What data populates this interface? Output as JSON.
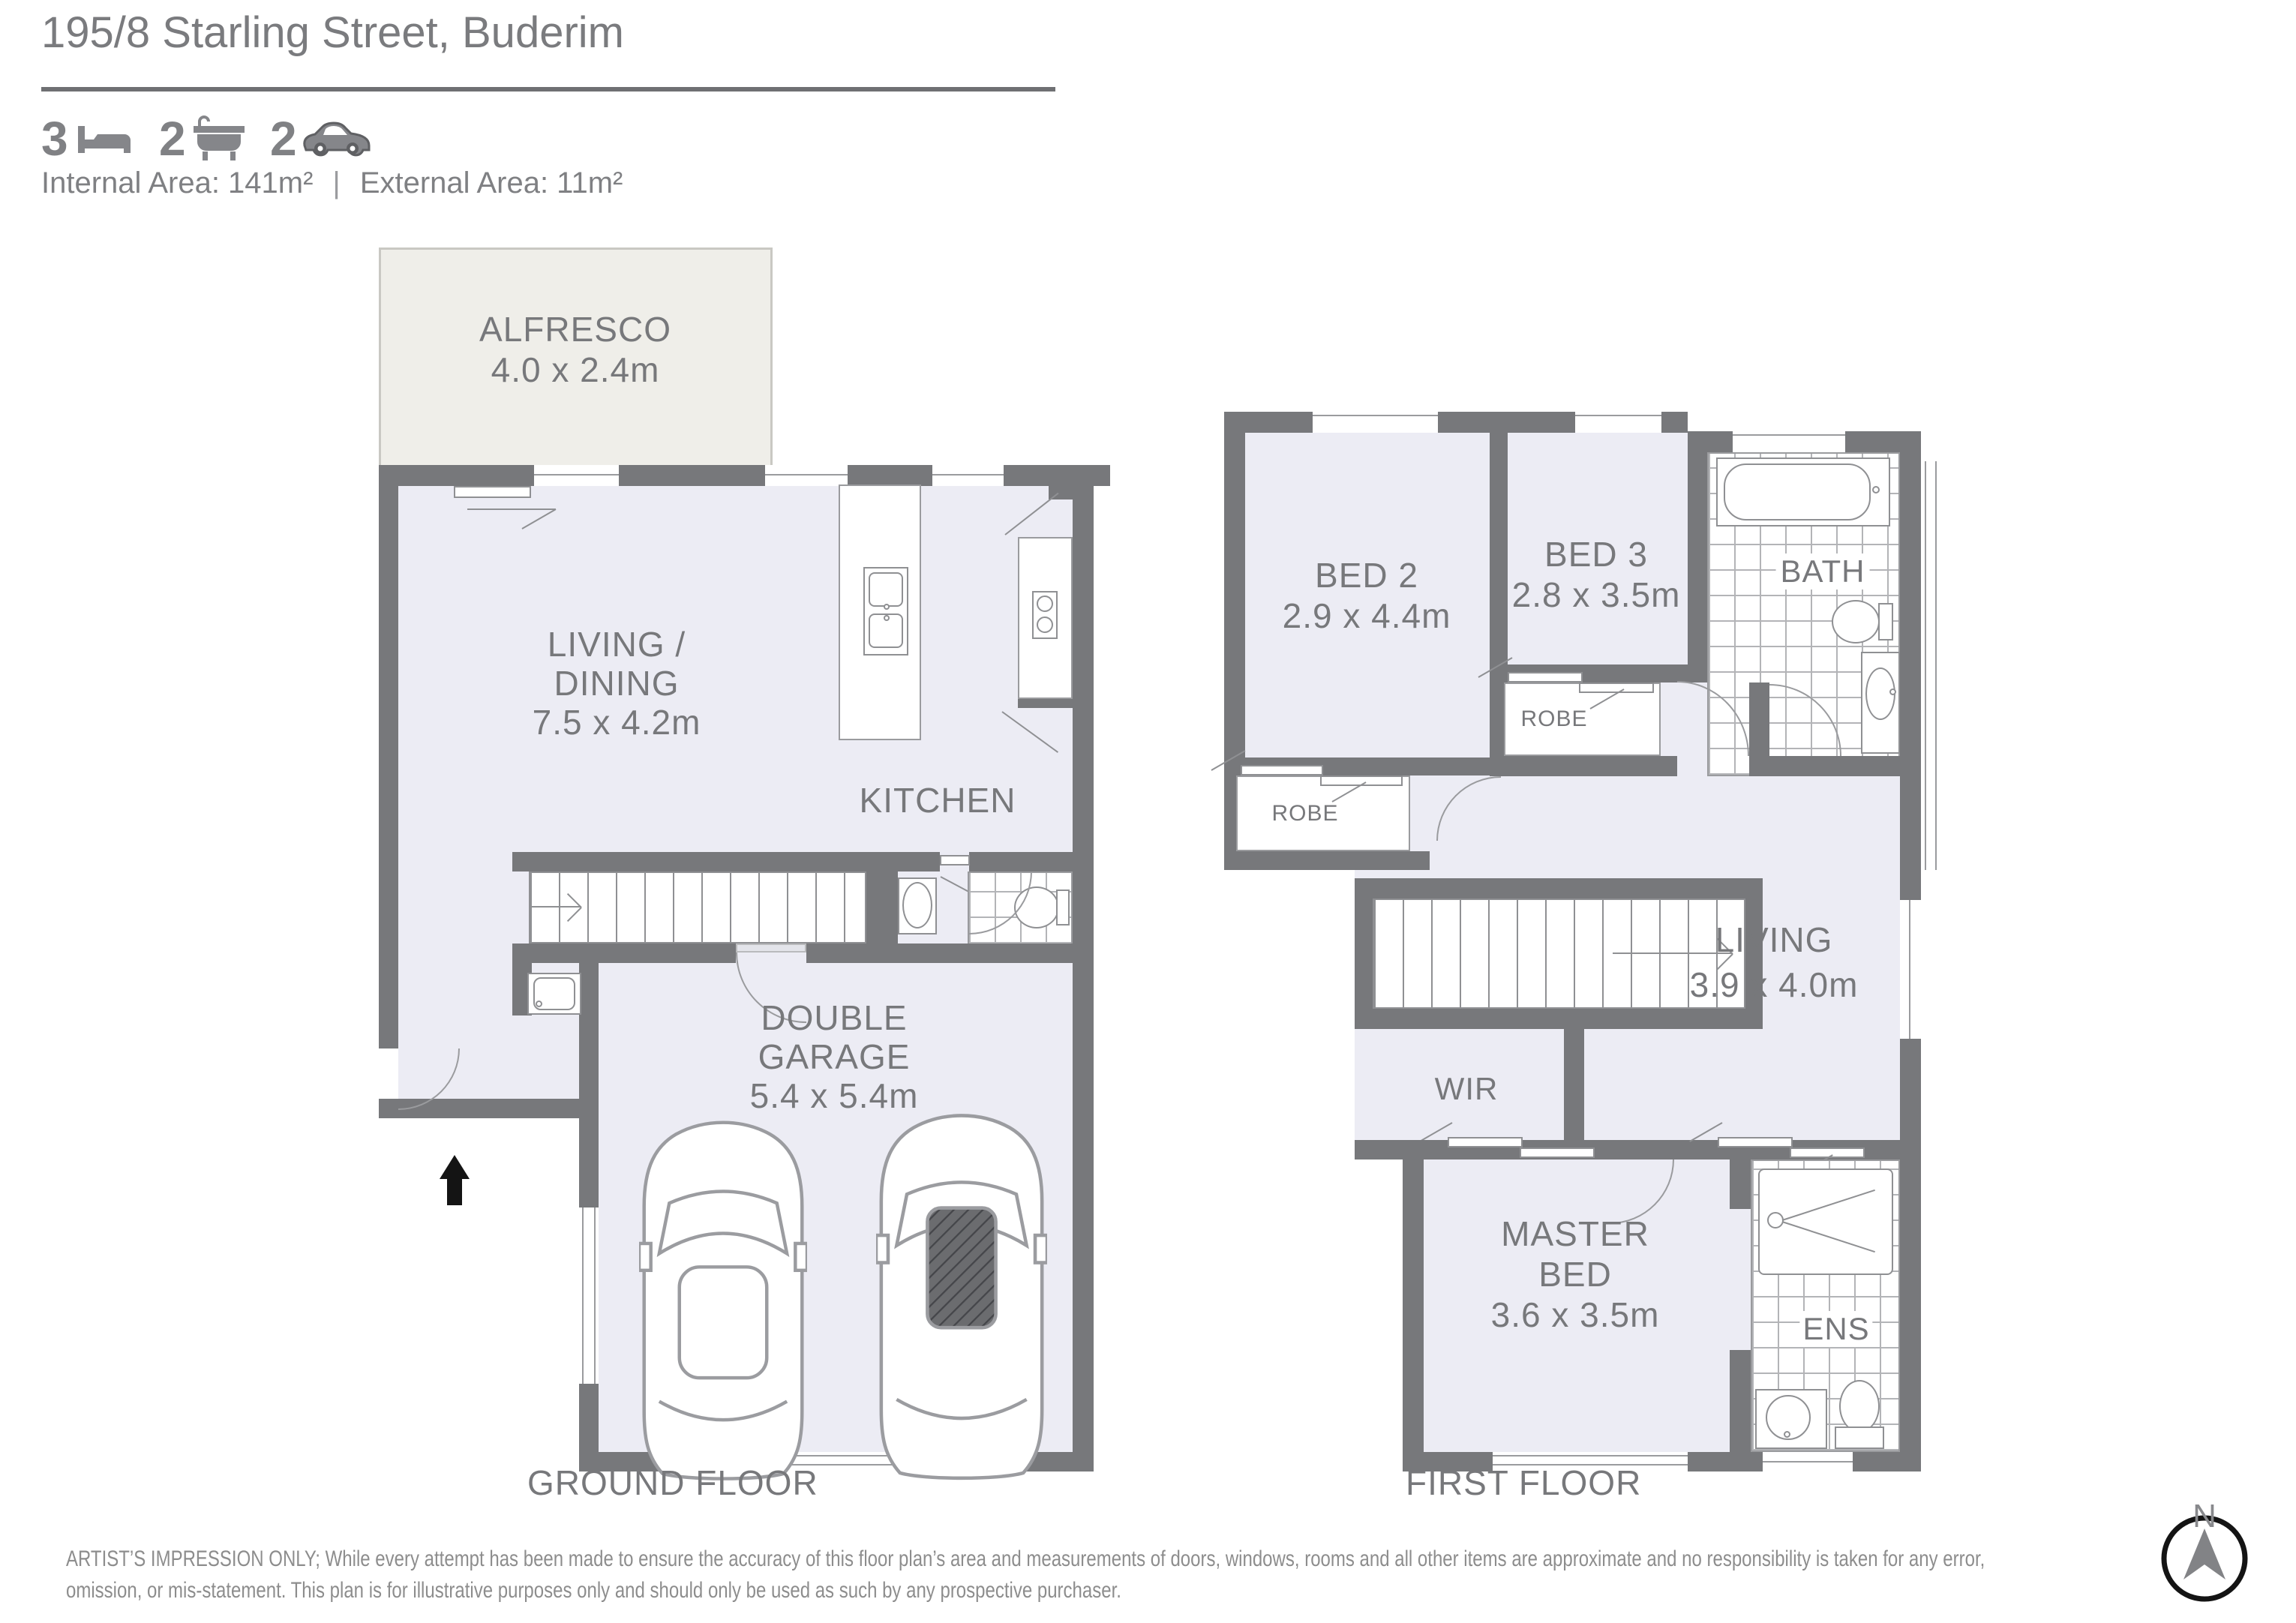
{
  "header": {
    "title": "195/8 Starling Street, Buderim",
    "stats": {
      "beds": "3",
      "baths": "2",
      "cars": "2"
    },
    "internal_area": "Internal Area: 141m²",
    "separator": "|",
    "external_area": "External Area: 11m²"
  },
  "ground_floor": {
    "label": "GROUND FLOOR",
    "alfresco": {
      "name": "ALFRESCO",
      "dims": "4.0 x 2.4m"
    },
    "living_dining": {
      "line1": "LIVING /",
      "line2": "DINING",
      "dims": "7.5 x 4.2m"
    },
    "kitchen": {
      "name": "KITCHEN"
    },
    "garage": {
      "line1": "DOUBLE",
      "line2": "GARAGE",
      "dims": "5.4 x 5.4m"
    }
  },
  "first_floor": {
    "label": "FIRST FLOOR",
    "bed2": {
      "name": "BED 2",
      "dims": "2.9 x 4.4m"
    },
    "bed3": {
      "name": "BED 3",
      "dims": "2.8 x 3.5m"
    },
    "bath": {
      "name": "BATH"
    },
    "robe_bed2": {
      "name": "ROBE"
    },
    "robe_bed3": {
      "name": "ROBE"
    },
    "living": {
      "name": "LIVING",
      "dims": "3.9 x 4.0m"
    },
    "wir": {
      "name": "WIR"
    },
    "master": {
      "line1": "MASTER",
      "line2": "BED",
      "dims": "3.6 x 3.5m"
    },
    "ens": {
      "name": "ENS"
    }
  },
  "compass": {
    "label": "N"
  },
  "disclaimer": {
    "line1": "ARTIST’S IMPRESSION ONLY; While every attempt has been made to ensure the accuracy of this floor plan’s area and measurements of doors, windows, rooms and all other items are approximate and no responsibility is taken for any error,",
    "line2": "omission, or mis-statement. This plan is for illustrative purposes only and should only be used as such by any prospective purchaser."
  },
  "colors": {
    "wall": "#77787b",
    "floor": "#ececf4",
    "alfresco": "#efeee9",
    "text": "#77787b"
  }
}
